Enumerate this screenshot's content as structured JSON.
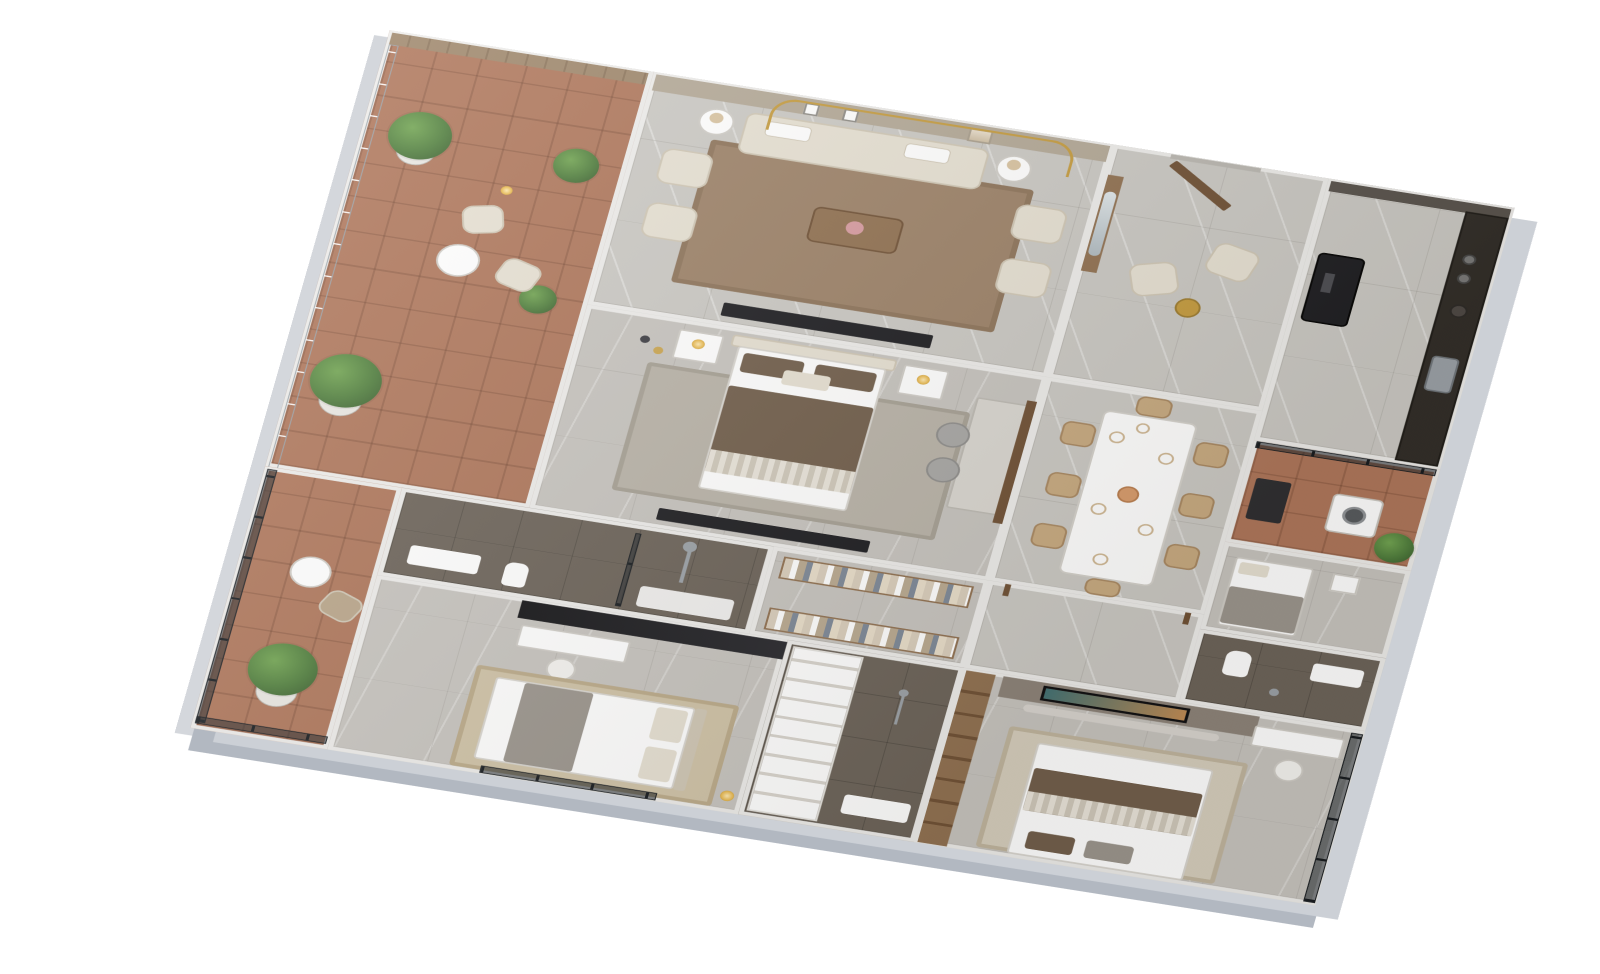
{
  "scene": {
    "type": "isometric-3d-floorplan-render",
    "description": "Photorealistic axonometric 3D floor plan of a furnished 3-bedroom apartment, white background, no visible text",
    "background_color": "#ffffff",
    "view": "top-down tilted, plan rotated about 12 degrees clockwise"
  },
  "palette": {
    "wall": "#edecea",
    "slab": "#c3c7ce",
    "marble": "#cac8c3",
    "bedroom_floor": "#c6c3be",
    "terracotta": "#ad7458",
    "dark_tile": "#6a6157",
    "wood": "#8f6f4f",
    "wood_dark": "#6e4f33",
    "feature_wall": "#b2a795",
    "gold": "#c49a3c",
    "cream": "#e6e0d2",
    "cream_dark": "#cfc6b4",
    "brown_duvet": "#6f5c49",
    "gray_throw": "#9a948c",
    "black": "#1a1a1e",
    "counter": "#2e2a25",
    "steel": "#9aa0a6",
    "tan": "#c7a97f",
    "jute": "#cfc2a6",
    "rug_brown": "#9b8066",
    "rug_gray": "#b8b2a7",
    "green": "#4d7c3a",
    "green_light": "#6fa34f",
    "green_dark": "#35582a",
    "white": "#ffffff",
    "tv_picture_a": "#3f6f72",
    "tv_picture_b": "#c08a52"
  },
  "rooms": {
    "terrace": {
      "label": "terrace-balcony",
      "floor": "terracotta-tile",
      "items": [
        "wood-slat-wall",
        "glass-railing",
        "potted-plant-large",
        "potted-plant",
        "potted-palm",
        "potted-plant-small",
        "lounge-chair",
        "lounge-chair",
        "round-side-table",
        "floor-lamp"
      ]
    },
    "living": {
      "label": "living-room",
      "floor": "marble-tile",
      "items": [
        "feature-wall-gold-arch",
        "wall-art-frame",
        "wall-art-frame",
        "wall-art-frame-large",
        "area-rug",
        "three-seat-sofa",
        "armchair",
        "armchair",
        "armchair",
        "armchair",
        "round-side-table",
        "round-side-table",
        "coffee-table",
        "tv-console"
      ]
    },
    "foyer": {
      "label": "entrance-foyer",
      "floor": "marble-tile",
      "items": [
        "entry-door-open",
        "wood-panel-mirror",
        "armchair",
        "armchair",
        "round-accent-table"
      ]
    },
    "kitchen": {
      "label": "kitchen",
      "floor": "marble-tile",
      "items": [
        "upper-cabinets",
        "black-refrigerator",
        "dark-marble-counter",
        "cooktop-burners",
        "kettle",
        "sink"
      ]
    },
    "utility": {
      "label": "utility-balcony",
      "floor": "terracotta-tile",
      "items": [
        "glass-partition",
        "base-cabinet",
        "washing-machine",
        "potted-plant"
      ]
    },
    "maid": {
      "label": "single-bedroom",
      "floor": "stone-tile",
      "items": [
        "single-bed",
        "nightstand"
      ]
    },
    "bath2": {
      "label": "bathroom-small",
      "floor": "dark-tile",
      "items": [
        "vanity-sink",
        "toilet",
        "shower-head"
      ]
    },
    "master": {
      "label": "master-bedroom",
      "floor": "stone-tile",
      "items": [
        "area-rug",
        "double-bed-brown",
        "nightstand",
        "nightstand",
        "table-lamp",
        "table-lamp",
        "tv-unit",
        "study-desk",
        "office-chair",
        "office-chair",
        "wall-shelf",
        "pendant-lights"
      ]
    },
    "dining": {
      "label": "dining-room",
      "floor": "marble-tile",
      "items": [
        "dining-table-8",
        "dining-chair",
        "dining-chair",
        "dining-chair",
        "dining-chair",
        "dining-chair",
        "dining-chair",
        "dining-chair",
        "dining-chair",
        "flower-vase",
        "plates"
      ]
    },
    "corridor": {
      "label": "corridor",
      "floor": "marble-tile",
      "items": [
        "door-jamb",
        "door-jamb"
      ]
    },
    "mbath": {
      "label": "master-bathroom",
      "floor": "dark-tile",
      "items": [
        "vanity-sink",
        "toilet",
        "glass-shower-screen",
        "shower-pole",
        "shower-tray"
      ]
    },
    "closet": {
      "label": "walk-in-closet",
      "floor": "stone-tile",
      "items": [
        "wardrobe-rack-clothes",
        "wardrobe-rack-clothes"
      ]
    },
    "balcony2": {
      "label": "bedroom-balcony",
      "floor": "terracotta-tile",
      "items": [
        "glass-railing",
        "glass-railing",
        "potted-palm",
        "round-side-table",
        "lounge-chair"
      ]
    },
    "bed2": {
      "label": "bedroom-2",
      "floor": "stone-tile",
      "items": [
        "black-media-wall",
        "study-desk",
        "desk-chair",
        "jute-rug",
        "double-bed-white",
        "window-glass",
        "floor-lamp"
      ]
    },
    "central": {
      "label": "closet-and-shower-room",
      "floor": "stone-tile",
      "items": [
        "shoe-shelf-unit",
        "dark-shower-floor",
        "vanity-sink",
        "shower-head"
      ]
    },
    "bed3": {
      "label": "bedroom-3",
      "floor": "stone-tile",
      "items": [
        "wardrobe-open",
        "tv-feature-wall",
        "wall-tv-playing",
        "floating-console",
        "study-desk",
        "desk-chair",
        "area-rug",
        "double-bed",
        "window-glass-wall"
      ]
    }
  }
}
